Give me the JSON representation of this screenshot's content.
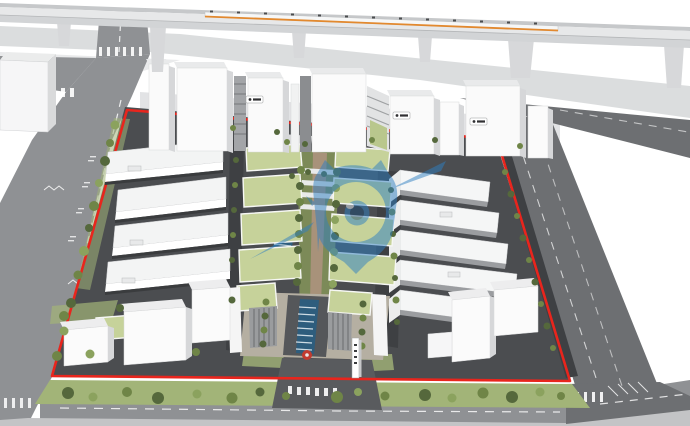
{
  "image": {
    "kind": "3D aerial architectural rendering (SketchUp style)",
    "subject": "Industrial park masterplan: red site-boundary line, central landscaped axis with water features, rows of white industrial buildings, green-roof offices, north high-rise towers, perimeter roads and an elevated rail viaduct with a passing train",
    "width_px": 690,
    "height_px": 426
  },
  "colors": {
    "background": "#ffffff",
    "viaduct_deck": "#e7e8e9",
    "viaduct_side": "#d2d4d6",
    "viaduct_edge": "#c6c8ca",
    "shadow": "#cfd1d3",
    "road": "#8f9194",
    "road_dark": "#6d6f72",
    "sidewalk": "#c3c4c6",
    "site_asphalt": "#4b4d50",
    "inner_road": "#3e4043",
    "boundary_red": "#e8251d",
    "building_white": "#fafafa",
    "building_side": "#d6d7d9",
    "green_roof": "#c6d29a",
    "lawn": "#a2b478",
    "hedge_dark": "#55683c",
    "tree_mid": "#6f8547",
    "tree_light": "#8ba25e",
    "pool_blue": "#2e5d7d",
    "path_tan": "#a8927a",
    "court_deck": "#b5afa2",
    "watermark_blue": "#2f7fc2",
    "train_orange": "#e2892f",
    "sculpture_red": "#c23b30",
    "plaque_dark": "#303032"
  },
  "watermark": {
    "name": "location-pin-eye logo watermark",
    "fill": "#2f7fc2",
    "opacity": "0.5"
  },
  "signs": {
    "tower_plaques_count": 3,
    "tower_plaques_note": "tiny logo plaques on tower facades, text not legible",
    "entrance_totem_note": "white totem sign at south entrance, text not legible"
  },
  "scene_features": [
    "elevated rail viaduct with train (orange stripe)",
    "red site boundary outline",
    "central landscaped axis with tree rows",
    "linear reflecting pool with crossing slabs",
    "red ring sculpture at south entrance",
    "green-roof mid-rise buildings",
    "white warehouse rows east and west",
    "high-rise towers along north edge",
    "perimeter city roads with crosswalks",
    "street trees, hedges and lawn strip"
  ]
}
